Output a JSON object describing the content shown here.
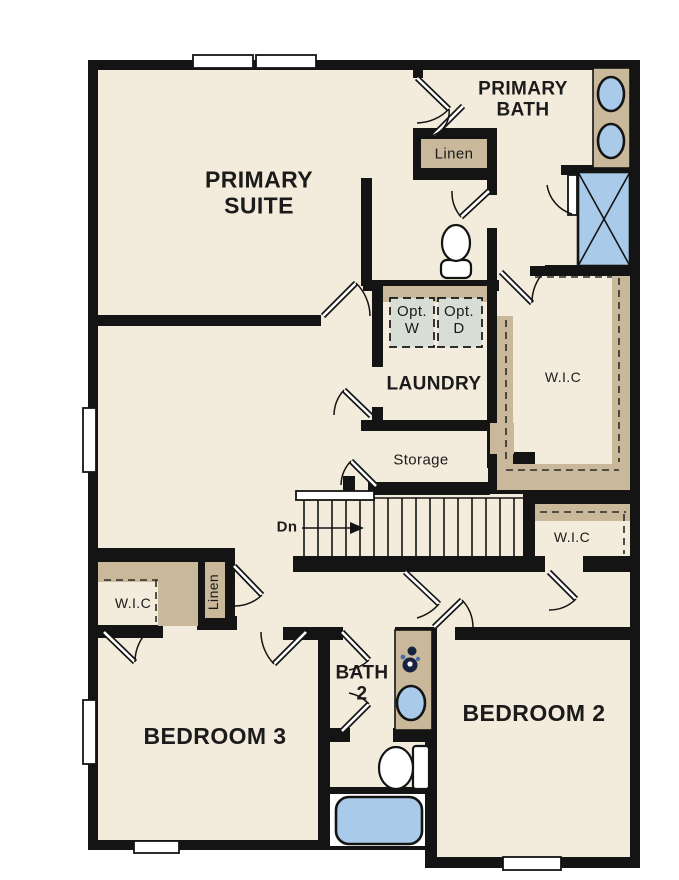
{
  "plan": {
    "rooms": {
      "primary_suite": {
        "label": "PRIMARY\nSUITE"
      },
      "primary_bath": {
        "label": "PRIMARY\nBATH"
      },
      "linen_upper": {
        "label": "Linen"
      },
      "opt_washer": {
        "label": "Opt.\nW"
      },
      "opt_dryer": {
        "label": "Opt.\nD"
      },
      "laundry": {
        "label": "LAUNDRY"
      },
      "wic_primary": {
        "label": "W.I.C"
      },
      "storage": {
        "label": "Storage"
      },
      "stairs_down": {
        "label": "Dn"
      },
      "wic_hall": {
        "label": "W.I.C"
      },
      "wic_bedroom3": {
        "label": "W.I.C"
      },
      "linen_lower": {
        "label": "Linen"
      },
      "bedroom3": {
        "label": "BEDROOM 3"
      },
      "bath2": {
        "label": "BATH\n2"
      },
      "bedroom2": {
        "label": "BEDROOM 2"
      }
    }
  },
  "colors": {
    "floor": "#f3ebdb",
    "wall": "#141414",
    "cabinetry": "#c9b899",
    "fixture_blue": "#a9cbe9",
    "appliance_fill": "#d8ddd6",
    "label": "#1b1b1b"
  }
}
